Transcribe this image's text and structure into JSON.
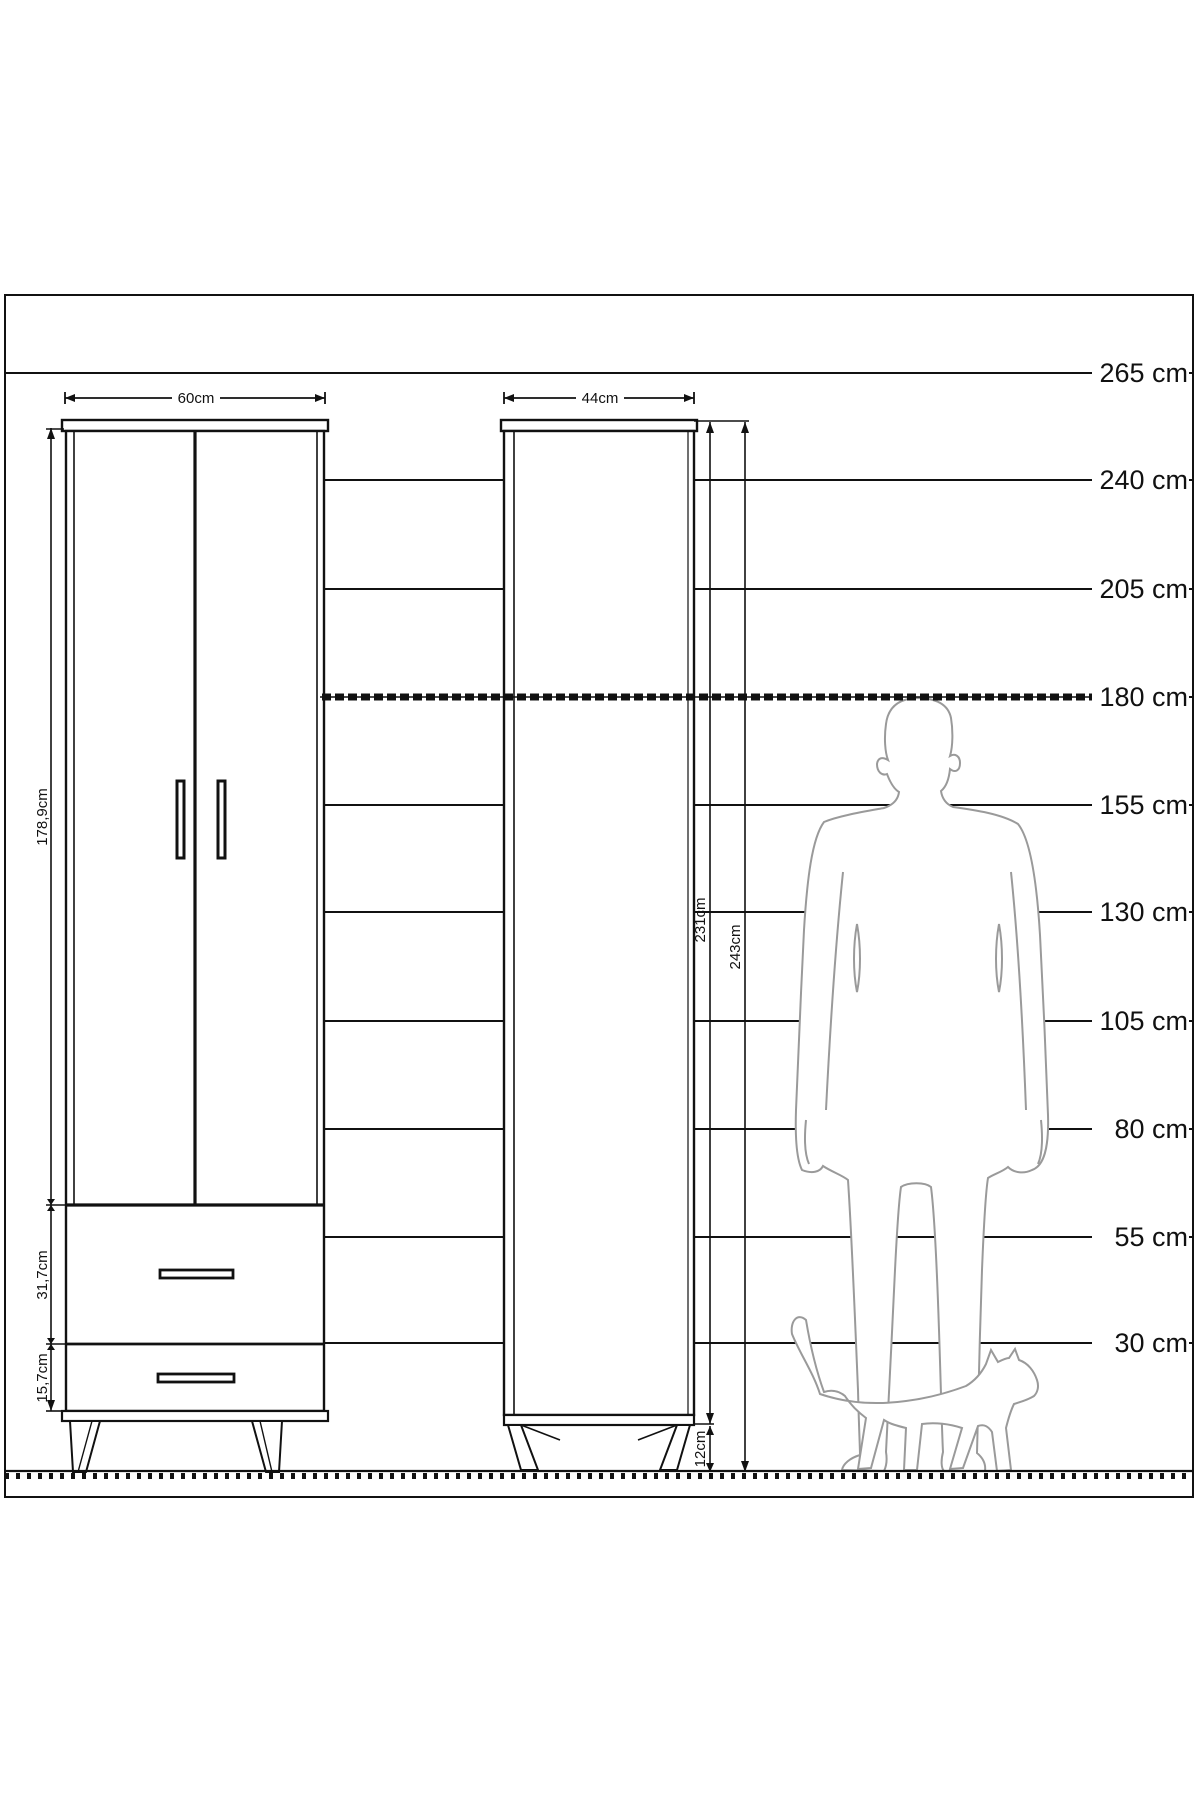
{
  "scale": {
    "unit": "cm",
    "labels": [
      "265 cm",
      "240 cm",
      "205 cm",
      "180 cm",
      "155 cm",
      "130 cm",
      "105 cm",
      "80 cm",
      "55 cm",
      "30 cm"
    ]
  },
  "wardrobe": {
    "width": "60cm",
    "height": "178,9cm",
    "drawer_top": "31,7cm",
    "drawer_bottom": "15,7cm"
  },
  "cabinet": {
    "width": "44cm",
    "body_height": "231cm",
    "total_height": "243cm",
    "legs": "12cm"
  }
}
